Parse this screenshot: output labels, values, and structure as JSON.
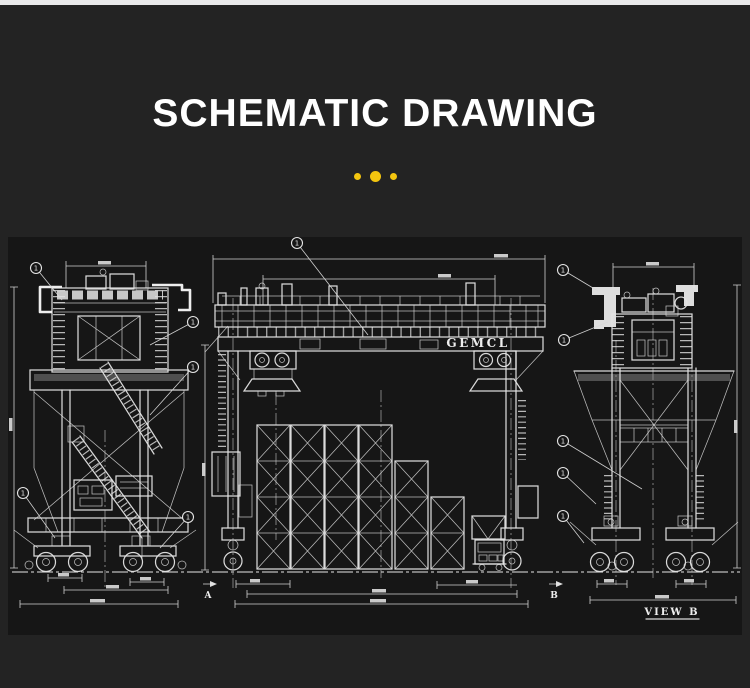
{
  "page": {
    "top_strip_color": "#e9e9ea",
    "background_color": "#232323",
    "panel_background_color": "#161616",
    "line_color": "#e4e4e4",
    "accent_color": "#f3c50f"
  },
  "header": {
    "title": "SCHEMATIC DRAWING"
  },
  "divider": {
    "dot_count": 3
  },
  "drawing": {
    "girder_brand": "GEMCL",
    "view_b_label": "VIEW B",
    "marker_a": "A",
    "marker_b": "B",
    "balloon_label": "1",
    "views": {
      "left": "crane side elevation",
      "center": "gantry front elevation with container stacks and truck",
      "right": "crane end elevation"
    }
  }
}
